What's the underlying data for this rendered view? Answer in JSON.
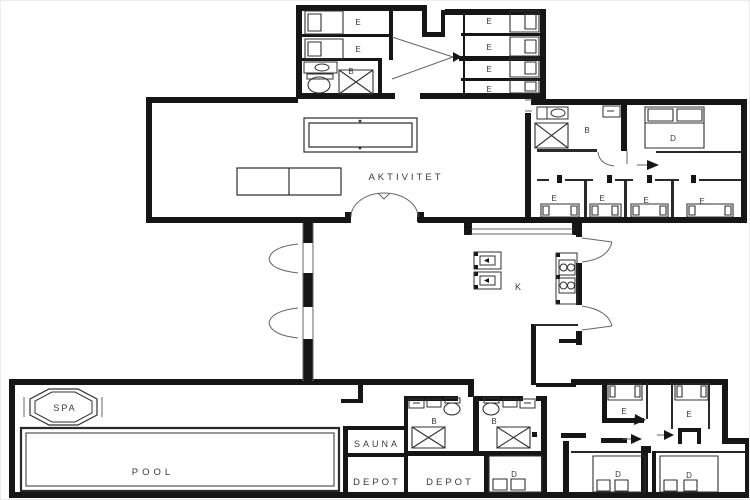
{
  "figure": {
    "type": "floor-plan",
    "background": "#ffffff",
    "wall_color": "#161616",
    "thin_wall_color": "#2a2a2a",
    "furniture_line_color": "#303030",
    "door_swing_color": "#666666",
    "label_color": "#3a3a3a"
  },
  "icons": {
    "bed": "rect-with-pillow",
    "shower": "x-box",
    "toilet": "ellipse-with-tank",
    "sink": "rect-with-oval",
    "stove": "rect-with-burner-circles",
    "billiard_table": "double-rounded-rect",
    "dining_table": "split-rect",
    "spa": "double-octagon",
    "door": "quarter-arc",
    "entrance": "black-arrow"
  },
  "rooms": {
    "activity": "AKTIVITET",
    "kitchen": "K",
    "spa": "SPA",
    "pool": "POOL",
    "sauna": "SAUNA",
    "depots": [
      "DEPOT",
      "DEPOT"
    ],
    "baths": [
      "B",
      "B",
      "B",
      "B"
    ],
    "singles": [
      "E",
      "E",
      "E",
      "E",
      "E",
      "E",
      "E",
      "E",
      "E",
      "E",
      "E",
      "E"
    ],
    "doubles": [
      "D",
      "D",
      "D",
      "D"
    ]
  }
}
